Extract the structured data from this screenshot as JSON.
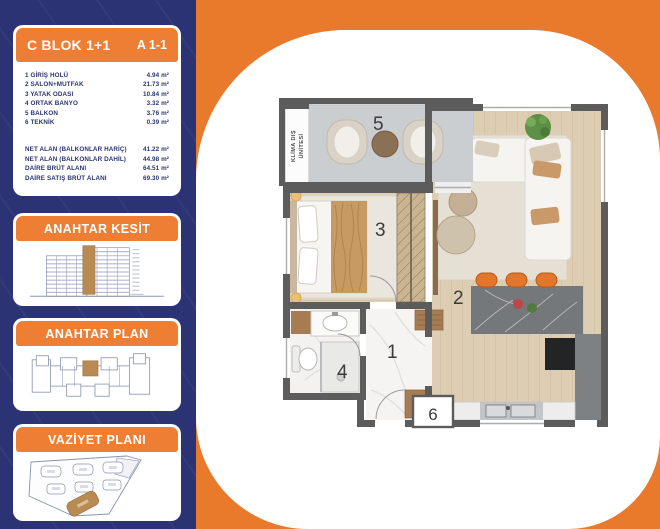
{
  "colors": {
    "background_orange": "#E97A2B",
    "sidebar_navy": "#2B3374",
    "band_orange": "#EE7E33",
    "highlight_brown": "#B98B52",
    "wall_gray": "#5C5C5C"
  },
  "sidebar": {
    "unit_card": {
      "block_title": "C BLOK 1+1",
      "unit_code": "A 1-1",
      "rooms": [
        {
          "name": "1 GİRİŞ HOLÜ",
          "area": "4.94 m²"
        },
        {
          "name": "2 SALON+MUTFAK",
          "area": "21.73 m²"
        },
        {
          "name": "3 YATAK ODASI",
          "area": "10.84 m²"
        },
        {
          "name": "4 ORTAK BANYO",
          "area": "3.32 m²"
        },
        {
          "name": "5 BALKON",
          "area": "3.76 m²"
        },
        {
          "name": "6 TEKNİK",
          "area": "0.39 m²"
        }
      ],
      "totals": [
        {
          "label": "NET ALAN (BALKONLAR HARİÇ)",
          "value": "41.22 m²"
        },
        {
          "label": "NET ALAN (BALKONLAR DAHİL)",
          "value": "44.98 m²"
        },
        {
          "label": "DAİRE BRÜT ALANI",
          "value": "64.51 m²"
        },
        {
          "label": "DAİRE SATIŞ BRÜT ALANI",
          "value": "69.30 m²"
        }
      ]
    },
    "section_card_title": "ANAHTAR KESİT",
    "keyplan_card_title": "ANAHTAR PLAN",
    "siteplan_card_title": "VAZİYET PLANI"
  },
  "floor_plan": {
    "room_numbers": {
      "hall": "1",
      "salon_kitchen": "2",
      "bedroom": "3",
      "bathroom": "4",
      "balcony": "5",
      "technic": "6"
    },
    "ac_unit_label_line1": "KLİMA DIŞ",
    "ac_unit_label_line2": "ÜNİTESİ"
  }
}
